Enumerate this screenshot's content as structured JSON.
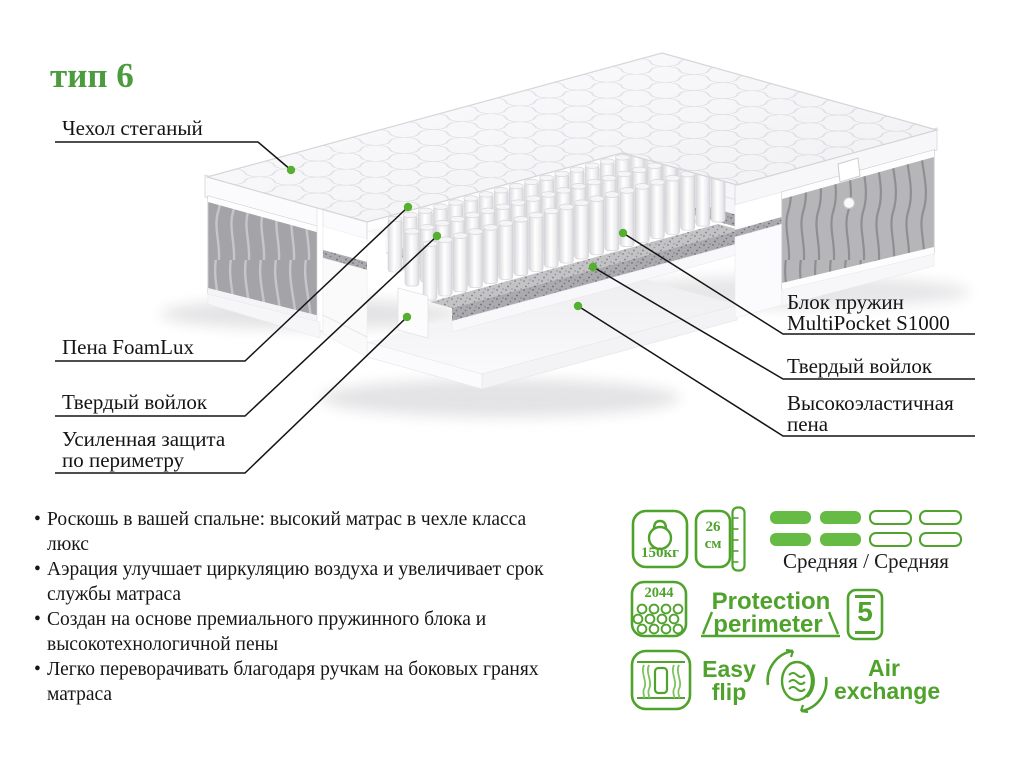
{
  "title": "тип 6",
  "callouts": {
    "cover": "Чехол стеганый",
    "foam": "Пена FoamLux",
    "felt_left": "Твердый войлок",
    "perimeter_l1": "Усиленная защита",
    "perimeter_l2": "по периметру",
    "springs_l1": "Блок пружин",
    "springs_l2": "MultiPocket S1000",
    "felt_right": "Твердый войлок",
    "elastic_l1": "Высокоэластичная",
    "elastic_l2": "пена"
  },
  "bullets": [
    "Роскошь в вашей спальне: высокий матрас в чехле класса люкс",
    "Аэрация улучшает циркуляцию воздуха и увеличивает срок службы матраса",
    "Создан на основе премиального пружинного блока и высокотехнологичной пены",
    "Легко переворачивать благодаря ручкам на боковых гранях матраса"
  ],
  "features": {
    "max_weight": "150кг",
    "height_value": "26",
    "height_unit": "см",
    "firmness": "Средняя / Средняя",
    "springs_count": "2044",
    "protection_l1": "Protection",
    "protection_l2": "perimeter",
    "warranty_years": "5",
    "flip_l1": "Easy",
    "flip_l2": "flip",
    "air_l1": "Air",
    "air_l2": "exchange"
  },
  "colors": {
    "green": "#4fa32c",
    "green_fill": "#65bb44",
    "dot": "#56b02f",
    "title_green": "#4c9b3e"
  }
}
